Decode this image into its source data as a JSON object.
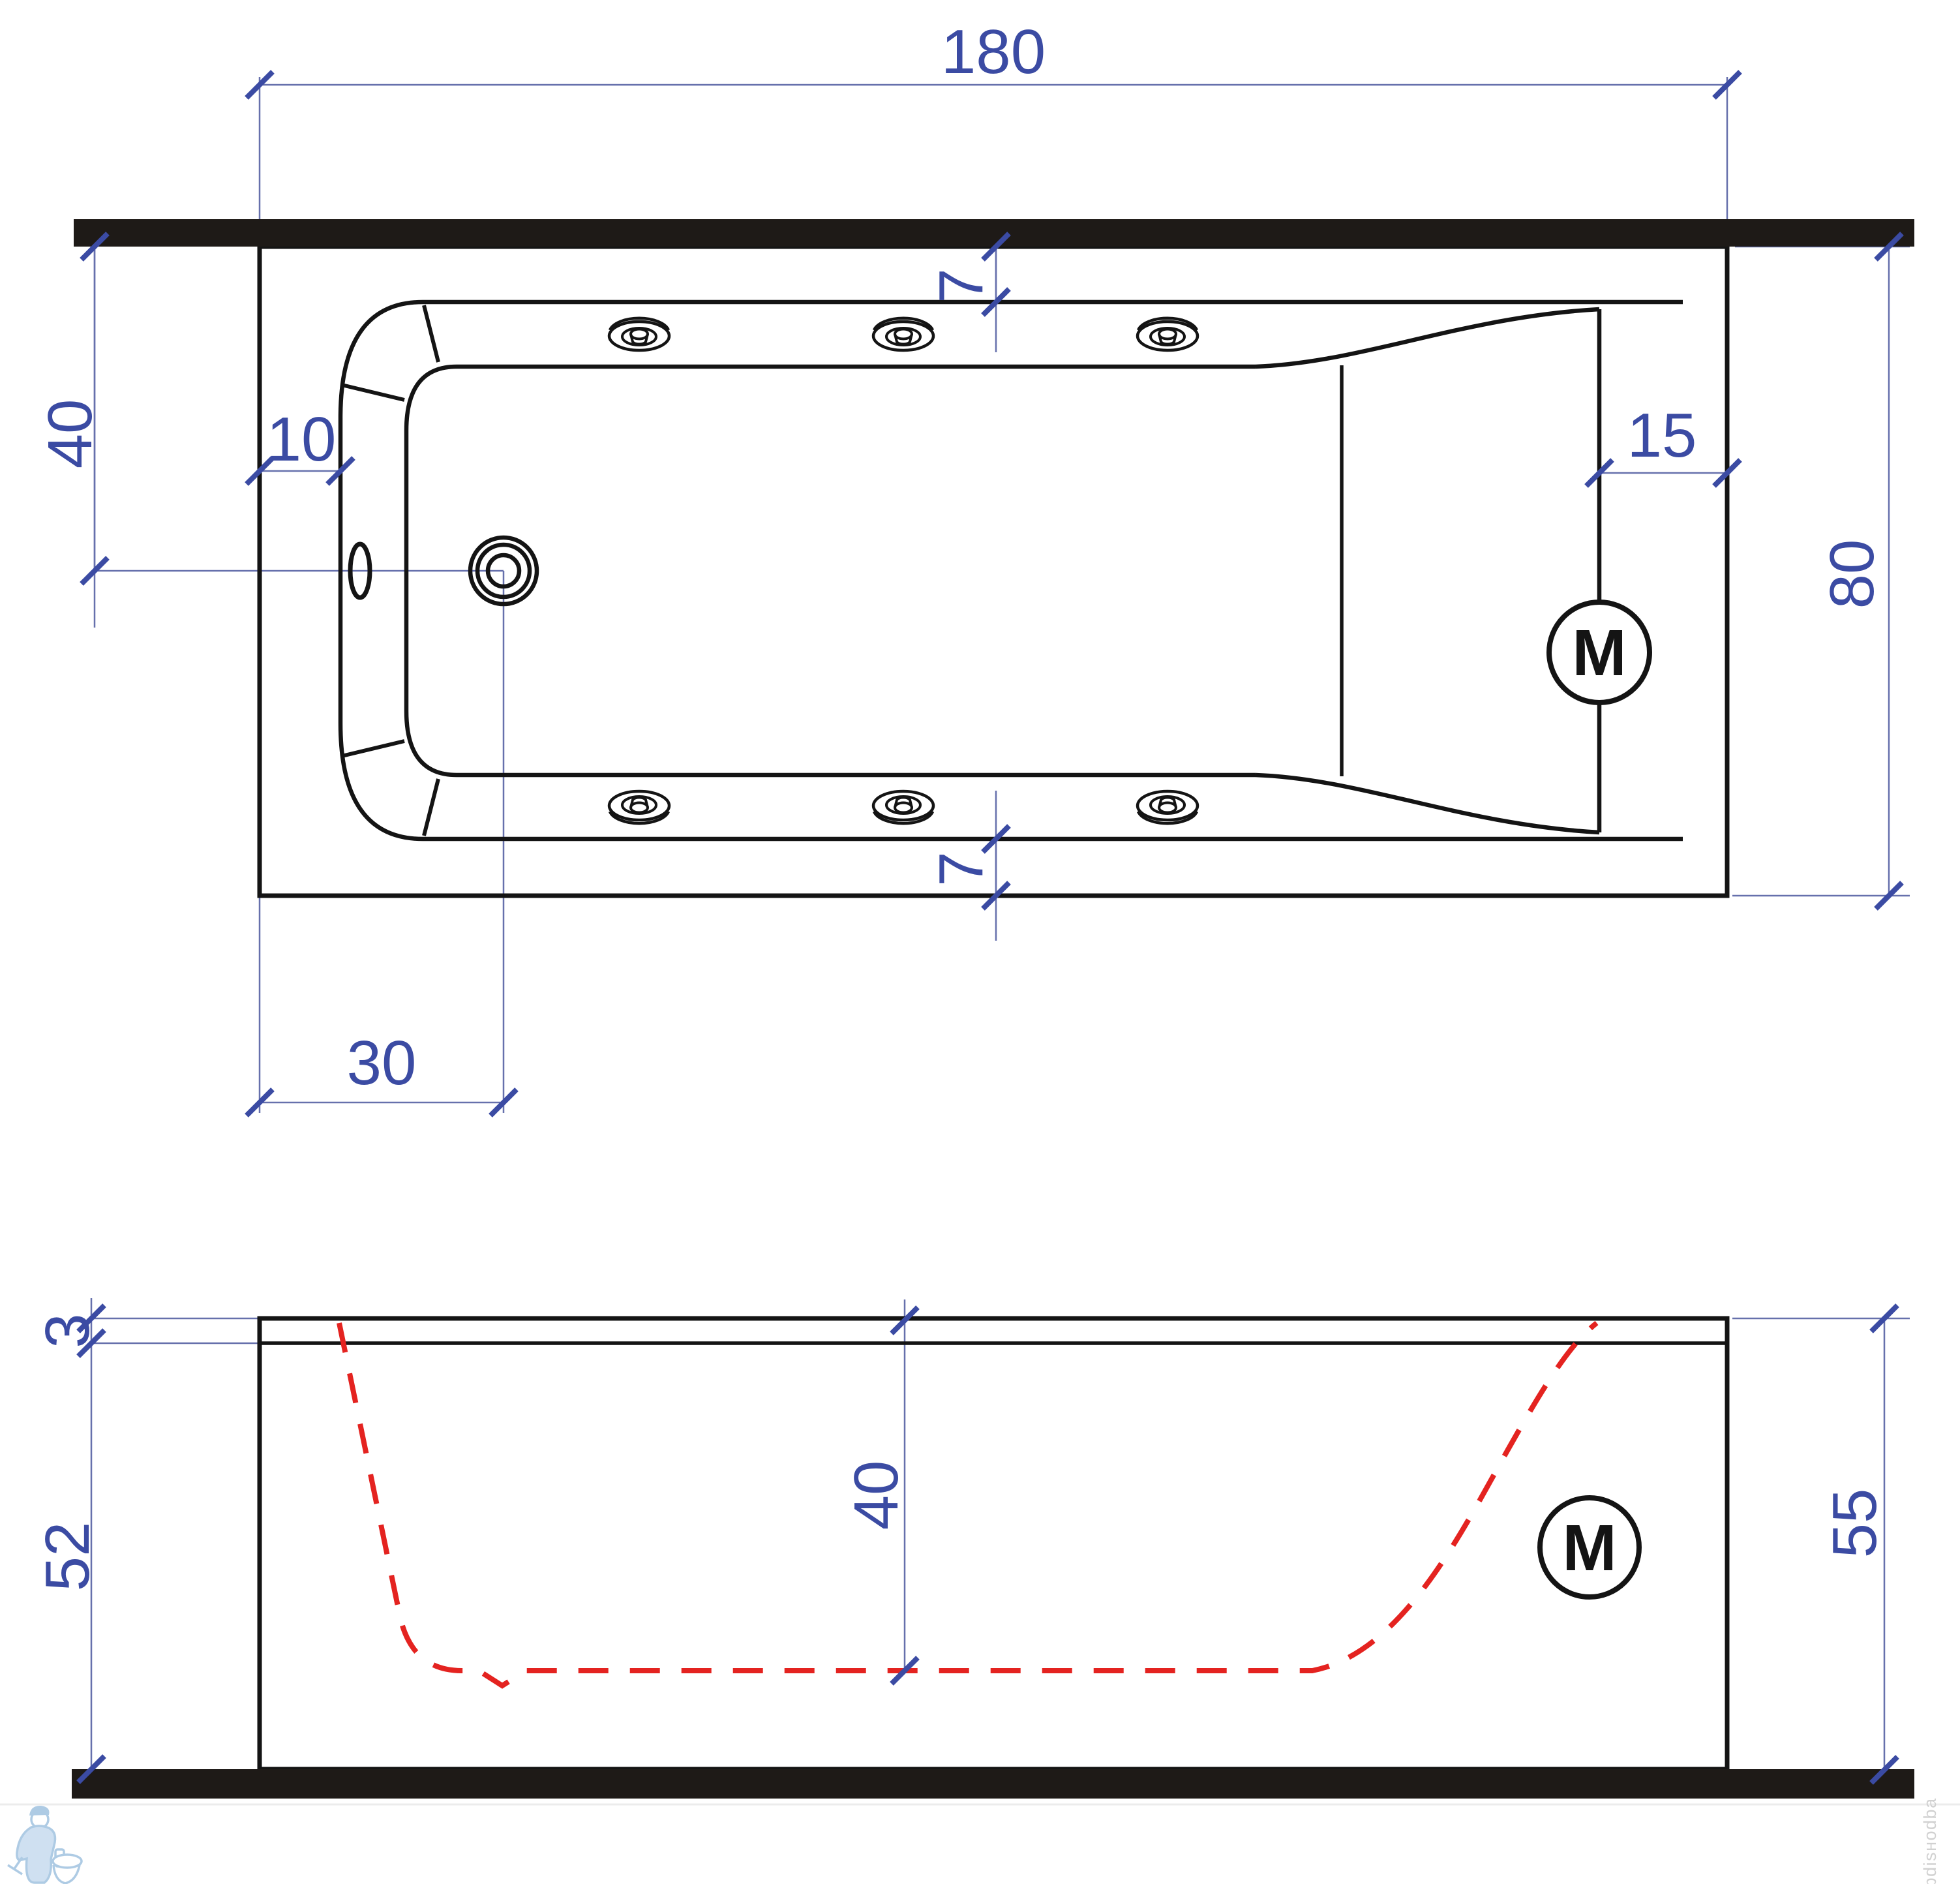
{
  "dimensions": {
    "length": "180",
    "drain_from_wall": "40",
    "rim_inset_left": "10",
    "rim_band_top": "7",
    "headrest_depth": "15",
    "width": "80",
    "rim_band_bottom": "7",
    "drain_from_left": "30",
    "rim_thickness": "3",
    "apron_height": "52",
    "inner_depth": "40",
    "overall_height": "55"
  },
  "labels": {
    "motor_plan": "M",
    "motor_side": "M"
  },
  "watermark": {
    "side_text": "фdisнodba"
  },
  "colors": {
    "dimension_blue": "#3B4BA3",
    "extension_blue": "#6670AC",
    "profile_red": "#E42320",
    "line_black": "#141414",
    "wall_fill": "#1E1A17",
    "logo_blue": "#AECBE4",
    "watermark_gray": "#C9C9C9"
  }
}
